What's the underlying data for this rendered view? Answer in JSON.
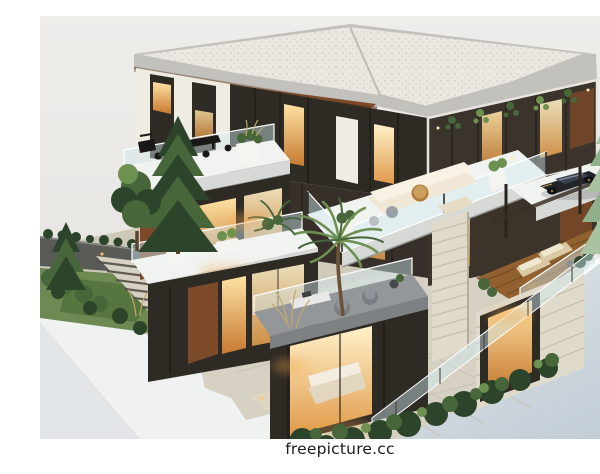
{
  "image": {
    "description": "Isometric 3D architectural render of a modern multi-storey villa model: flat gravel roofs, glass walls with warm lit interiors, stacked balconies and terraces with cream sofas and lounge chairs, a dark sports car on a cantilevered pad, palm and pine trees, stone garden stairs and pathway, all sitting on a pale display plinth",
    "watermark": "freepicture.cc"
  },
  "colors": {
    "sky1": "#eeece9",
    "sky2": "#e2e1de",
    "groundL": "#e2e6e8",
    "plinth": "#f0f2f2",
    "plinthEdge": "#f8f9f9",
    "roofTop": "#eae8e1",
    "roofDot": "#c9c5b9",
    "fascia1": "#c2c1bd",
    "fascia2": "#8f8e8a",
    "soffit": "#9c5c2a",
    "white": "#efece4",
    "slabWhite": "#f1f3f1",
    "slabFace": "#d7d9d7",
    "slabGray": "#94979a",
    "glassDark": "#2e2a24",
    "glassFrame": "#17140f",
    "warm1": "#ffe2a4",
    "warm2": "#c67a31",
    "warmBright": "#fff1c9",
    "wood": "#7c4a28",
    "woodDeck": "#91602f",
    "stone": "#e0dacb",
    "stoneLine": "#c2bba8",
    "railGlass": "rgba(208,232,240,0.45)",
    "pathLight": "#d6d1c3",
    "pathMid": "#c7c1b1",
    "stepDark": "#514f47",
    "road": "#5a5b56",
    "greenD": "#2c452a",
    "greenM": "#47663a",
    "greenL": "#6d9150",
    "sage": "#a9c29f",
    "sage2": "#8fb08a",
    "lamp": "#ffc86e",
    "cream": "#f1e7d6",
    "creamShadow": "#ddd0bb",
    "gray1": "#74787c",
    "gray2": "#46494e",
    "car1": "#22242a",
    "car2": "#3c414b",
    "bar": "#ffffff",
    "text": "#1b1b1b"
  }
}
